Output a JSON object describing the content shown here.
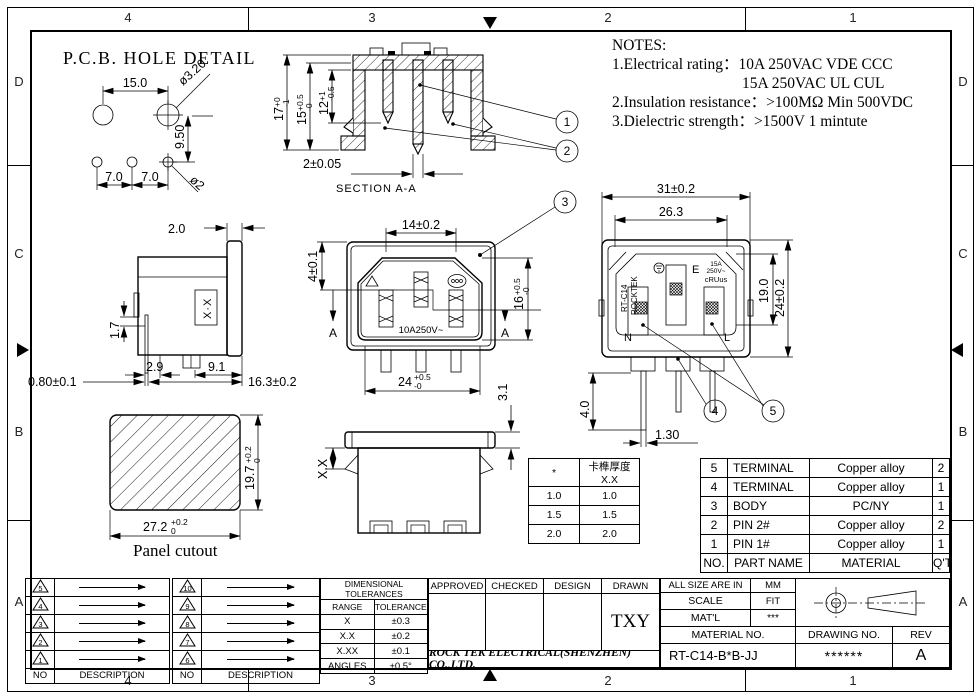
{
  "border": {
    "cols": [
      "4",
      "3",
      "2",
      "1"
    ],
    "rows": [
      "D",
      "C",
      "B",
      "A"
    ]
  },
  "pcb": {
    "title": "P.C.B. HOLE DETAIL",
    "pitch": "15.0",
    "dia_top": "ø3.20",
    "vspace": "9.50",
    "pitch_b1": "7.0",
    "pitch_b2": "7.0",
    "dia_bot": "ø2"
  },
  "section": {
    "label": "SECTION  A-A",
    "d2": "2±0.05",
    "d17": {
      "v": "17",
      "sup": "+0",
      "sub": "-1"
    },
    "d15": {
      "v": "15",
      "sup": "+0.5",
      "sub": "-0"
    },
    "d12": {
      "v": "12",
      "sup": "+1",
      "sub": "-0.5"
    },
    "balloon1": "1",
    "balloon2": "2"
  },
  "notes": {
    "title": "NOTES:",
    "line1": "1.Electrical rating：10A 250VAC   VDE CCC",
    "line2": "15A 250VAC   UL CUL",
    "line3": "2.Insulation resistance：>100MΩ Min 500VDC",
    "line4": "3.Dielectric strength：>1500V 1 mintute"
  },
  "front": {
    "d14": "14±0.2",
    "d4": "4±0.1",
    "rating": "10A250V~",
    "sec": "A",
    "d16": {
      "v": "16",
      "sup": "+0.5",
      "sub": "-0"
    },
    "d24": {
      "v": "24",
      "sup": "+0.5",
      "sub": "-0"
    },
    "balloon3": "3"
  },
  "side": {
    "d2": "2.0",
    "d17": "1.7",
    "d29": "2.9",
    "d91": "9.1",
    "d08": "0.80±0.1",
    "d163": "16.3±0.2",
    "xx": "X·X"
  },
  "rear": {
    "d31": "31±0.2",
    "d263": "26.3",
    "d19": "19.0",
    "d24": "24±0.2",
    "d4": "4.0",
    "d13": "1.30",
    "brand_model": "RT-C14",
    "brand_name": "ROCKTEK",
    "pin_e": "E",
    "pin_n": "N",
    "pin_l": "L",
    "rating1": "15A",
    "rating2": "250V~",
    "cert": "cRUus",
    "balloon4": "4",
    "balloon5": "5"
  },
  "panel": {
    "label": "Panel cutout",
    "d197": {
      "v": "19.7",
      "sup": "+0.2",
      "sub": "0"
    },
    "d272": {
      "v": "27.2",
      "sup": "+0.2",
      "sub": "0"
    }
  },
  "bottomview": {
    "d31": "3.1",
    "dxx": "X.X"
  },
  "thickness": {
    "h1": "*",
    "h2": "卡榫厚度 X.X",
    "rows": [
      [
        "1.0",
        "1.0"
      ],
      [
        "1.5",
        "1.5"
      ],
      [
        "2.0",
        "2.0"
      ]
    ]
  },
  "bom": {
    "rows": [
      {
        "no": "5",
        "name": "TERMINAL",
        "mat": "Copper alloy",
        "qty": "2"
      },
      {
        "no": "4",
        "name": "TERMINAL",
        "mat": "Copper alloy",
        "qty": "1"
      },
      {
        "no": "3",
        "name": "BODY",
        "mat": "PC/NY",
        "qty": "1"
      },
      {
        "no": "2",
        "name": "PIN 2#",
        "mat": "Copper alloy",
        "qty": "2"
      },
      {
        "no": "1",
        "name": "PIN 1#",
        "mat": "Copper alloy",
        "qty": "1"
      }
    ],
    "foot": {
      "no": "NO.",
      "name": "PART NAME",
      "mat": "MATERIAL",
      "qty": "Q'TY"
    }
  },
  "rev1": {
    "nos": [
      "5",
      "4",
      "3",
      "2",
      "1"
    ],
    "foot_no": "NO",
    "foot_desc": "DESCRIPTION"
  },
  "rev2": {
    "nos": [
      "10",
      "9",
      "8",
      "7",
      "6"
    ],
    "foot_no": "NO",
    "foot_desc": "DESCRIPTION"
  },
  "tol": {
    "title": "DIMENSIONAL TOLERANCES",
    "h1": "RANGE",
    "h2": "TOLERANCE",
    "rows": [
      [
        "X",
        "±0.3"
      ],
      [
        "X.X",
        "±0.2"
      ],
      [
        "X.XX",
        "±0.1"
      ],
      [
        "ANGLES",
        "±0.5°"
      ]
    ]
  },
  "tb": {
    "approved": "APPROVED",
    "checked": "CHECKED",
    "design": "DESIGN",
    "drawn": "DRAWN",
    "drawn_by": "TXY",
    "company": "ROCK TEK ELECTRICAL(SHENZHEN) CO.,LTD.",
    "size_label": "ALL SIZE ARE IN",
    "size_unit": "MM",
    "scale_label": "SCALE",
    "scale_value": "FIT",
    "matl_label": "MAT'L",
    "matl_value": "***",
    "matno_label": "MATERIAL NO.",
    "partno": "RT-C14-B*B-JJ",
    "dwg_label": "DRAWING NO.",
    "dwg_value": "******",
    "rev_label": "REV",
    "rev_value": "A"
  }
}
